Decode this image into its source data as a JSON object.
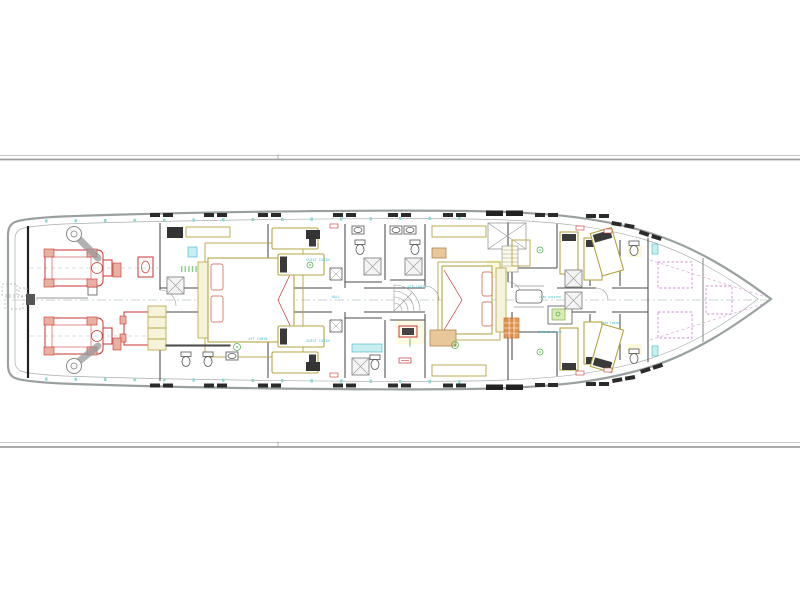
{
  "drawing": {
    "type": "yacht-lower-deck-general-arrangement-plan",
    "colors": {
      "hull": "#9aa0a0",
      "wall": "#4a4a4a",
      "furniture": "#b5a642",
      "accent_red": "#cc3333",
      "accent_cyan": "#3bbccc",
      "accent_green": "#55b055",
      "accent_magenta": "#cc8fcc",
      "accent_orange": "#e08838",
      "border_line": "#9e9e9e"
    },
    "labels": {
      "aft_cabin": "AFT CABIN",
      "guest_cabin_top": "GUEST CABIN",
      "guest_cabin_bottom": "GUEST CABIN",
      "hall": "HALL",
      "vip_cabin": "VIP CABIN",
      "laundry": "LAUNDRY",
      "crew_quarter": "CREW QUARTER",
      "captain_cabin": "CAPTAIN CABIN",
      "crew_cabin": "CREW CABIN"
    }
  }
}
